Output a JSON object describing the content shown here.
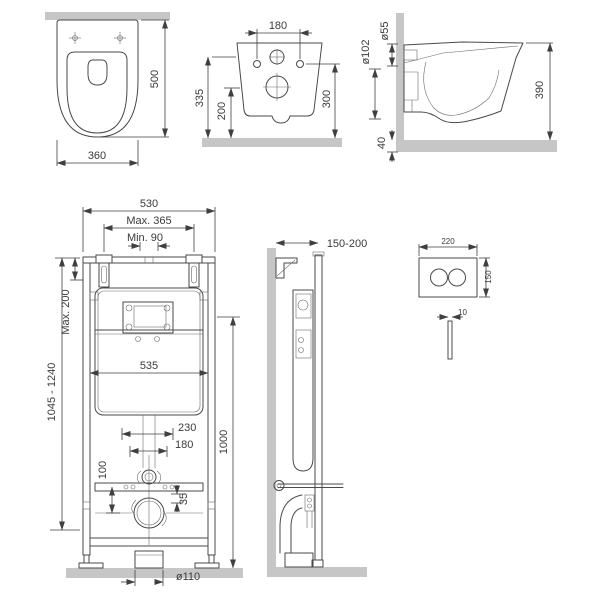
{
  "drawing": {
    "type": "installation-technical-drawing",
    "background": "#ffffff",
    "line_color": "#4a4a4a",
    "wall_fill": "#c6c6c6",
    "text_color": "#3a3a3a"
  },
  "views": {
    "toilet_top": {
      "depth": "500",
      "width": "360"
    },
    "toilet_back": {
      "hole_spacing": "180",
      "inlet_height": "335",
      "outlet_height": "200",
      "fixing_height": "300"
    },
    "toilet_side": {
      "inlet_diameter": "ø55",
      "outlet_diameter": "ø102",
      "depth": "390",
      "clearance": "40"
    },
    "frame_front": {
      "frame_width": "530",
      "max_spacing": "Max. 365",
      "min_spacing": "Min. 90",
      "max_top_extension": "Max. 200",
      "install_height_range": "1045 - 1240",
      "cistern_width": "535",
      "offset_a": "230",
      "offset_b": "180",
      "offset_c": "100",
      "offset_d": "35",
      "frame_height": "1000",
      "drain_diameter": "ø110"
    },
    "frame_side": {
      "wall_distance": "150-200"
    },
    "flush_plate": {
      "width": "220",
      "height": "150",
      "thickness": "10"
    }
  }
}
